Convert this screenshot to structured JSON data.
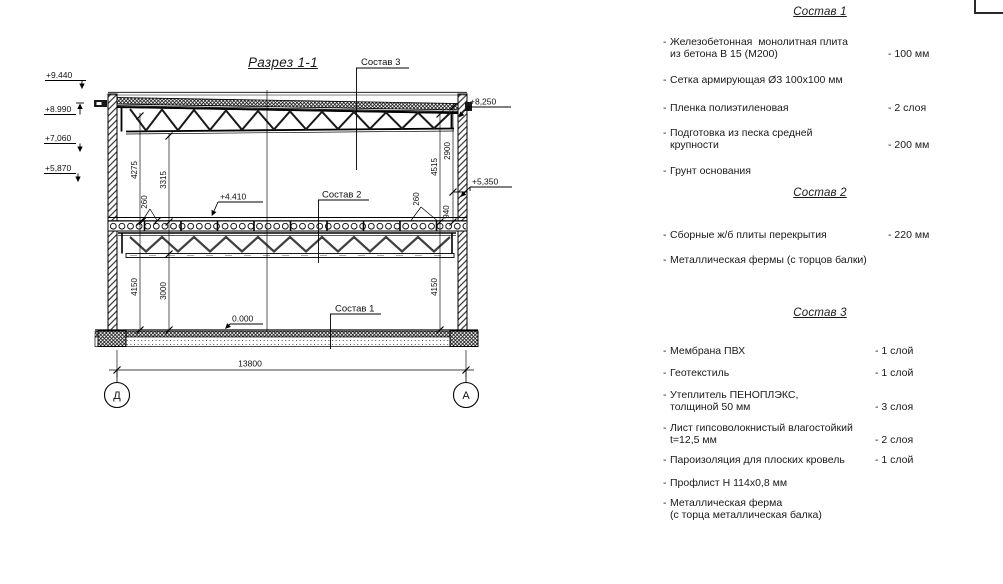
{
  "title": "Разрез 1-1",
  "bullet": "-",
  "drawing": {
    "elev": {
      "p9440": "+9.440",
      "p8990": "+8.990",
      "p7060": "+7,060",
      "p5870": "+5,870",
      "p8250": "+8,250",
      "p5350": "+5,350",
      "p4410": "+4.410",
      "zero": "0.000"
    },
    "dim": {
      "d4275": "4275",
      "d3315": "3315",
      "d260l": "260",
      "d4150l": "4150",
      "d3000": "3000",
      "d4515": "4515",
      "d2900": "2900",
      "d940": "940",
      "d260r": "260",
      "d4150r": "4150",
      "overall": "13800"
    },
    "axis_left": "Д",
    "axis_right": "А",
    "leader1": "Состав 1",
    "leader2": "Состав 2",
    "leader3": "Состав 3"
  },
  "sections": [
    {
      "heading": "Состав 1",
      "items": [
        {
          "name": "Железобетонная  монолитная плита\nиз бетона В 15 (М200)",
          "value": "- 100 мм"
        },
        {
          "name": "Сетка армирующая Ø3 100х100 мм",
          "value": ""
        },
        {
          "name": "Пленка полиэтиленовая",
          "value": "- 2 слоя"
        },
        {
          "name": "Подготовка из песка средней\nкрупности",
          "value": "- 200 мм"
        },
        {
          "name": "Грунт основания",
          "value": ""
        }
      ]
    },
    {
      "heading": "Состав 2",
      "items": [
        {
          "name": "Сборные ж/б плиты перекрытия",
          "value": "- 220 мм"
        },
        {
          "name": "Металлическая фермы (с торцов балки)",
          "value": ""
        }
      ]
    },
    {
      "heading": "Состав 3",
      "items": [
        {
          "name": "Мембрана ПВХ",
          "value": "- 1 слой"
        },
        {
          "name": "Геотекстиль",
          "value": "- 1 слой"
        },
        {
          "name": "Утеплитель ПЕНОПЛЭКС,\nтолщиной 50 мм",
          "value": "- 3 слоя"
        },
        {
          "name": "Лист гипсоволокнистый влагостойкий\nt=12,5 мм",
          "value": "- 2 слоя"
        },
        {
          "name": "Пароизоляция для плоских кровель",
          "value": "- 1 слой"
        },
        {
          "name": "Профлист Н 114х0,8 мм",
          "value": ""
        },
        {
          "name": "Металлическая ферма\n(с торца металлическая балка)",
          "value": ""
        }
      ]
    }
  ]
}
